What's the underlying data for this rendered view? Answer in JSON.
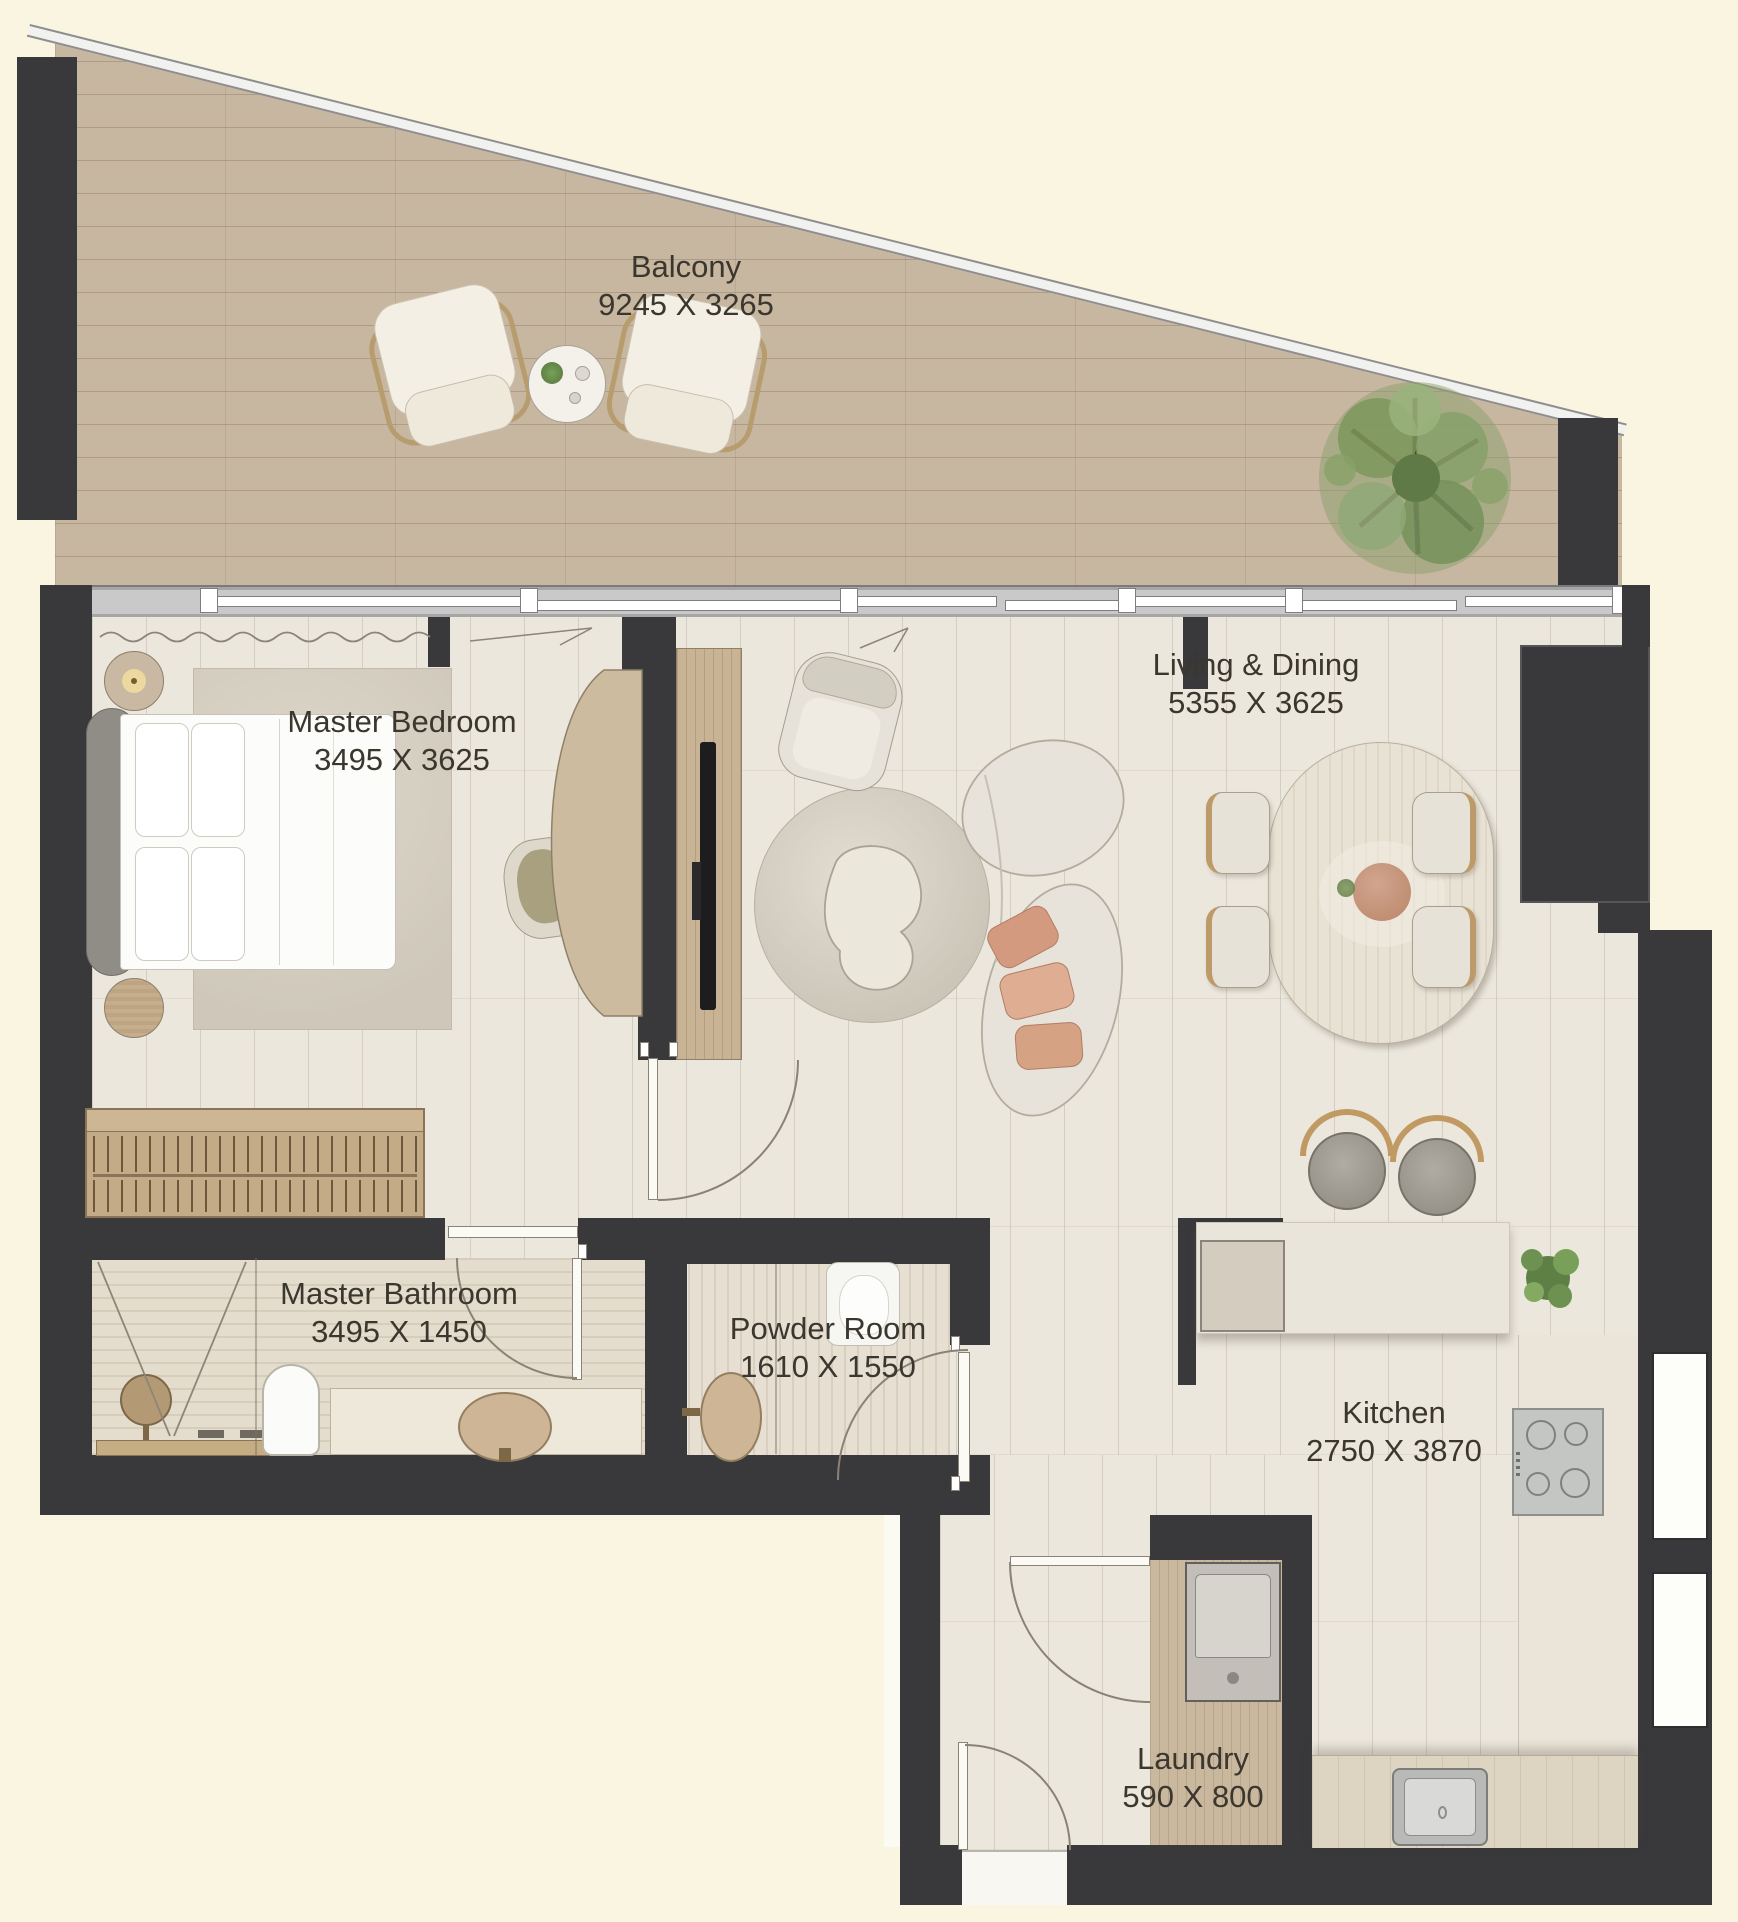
{
  "rooms": [
    {
      "label": "Balcony",
      "dims": "9245 X 3265"
    },
    {
      "label": "Master Bedroom",
      "dims": "3495 X 3625"
    },
    {
      "label": "Living & Dining",
      "dims": "5355 X 3625"
    },
    {
      "label": "Master Bathroom",
      "dims": "3495 X 1450"
    },
    {
      "label": "Powder Room",
      "dims": "1610 X 1550"
    },
    {
      "label": "Kitchen",
      "dims": "2750 X 3870"
    },
    {
      "label": "Laundry",
      "dims": "590 X 800"
    }
  ],
  "colors": {
    "background": "#faf5e1",
    "wall": "#39383a",
    "interior_floor": "#ece7dd",
    "balcony_wood": "#c7b6a0",
    "furniture_wood": "#c8b394",
    "label_text": "#3b372e",
    "greenery": "#6d8450"
  }
}
